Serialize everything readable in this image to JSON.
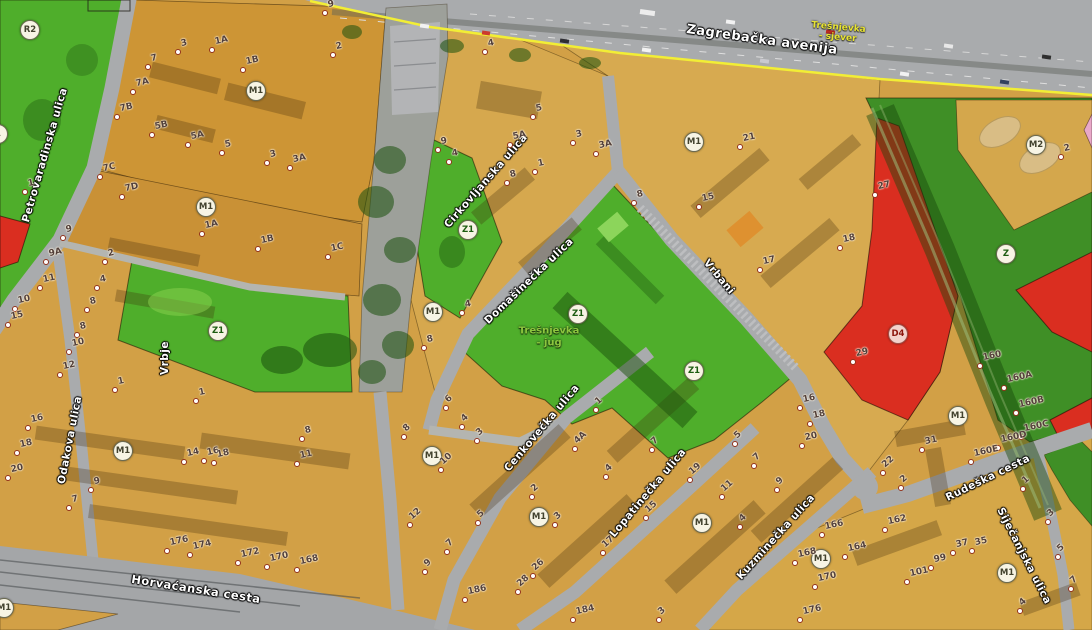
{
  "palette": {
    "zone-orange": "#d2a046",
    "zone-orange-dark": "#cd9535",
    "zone-orange-mid": "#c99136",
    "zone-orange-light": "#d7aa50",
    "zone-park": "#4fae2b",
    "zone-strip": "#3f8f26",
    "zone-red": "#da2e20",
    "zone-pink": "#e9a8c9",
    "road": "#a9abad",
    "road-light": "#b4b5b0",
    "corridor": "#9da09a",
    "boundary-yellow": "#f2ee35",
    "street-text": "#ffffff",
    "number-text": "#53403a",
    "area-sjever": "#e8e434",
    "area-jug": "#8cc63e",
    "circle-fill": "#f7f4e4",
    "circle-z": "#1c5c10",
    "circle-m": "#42422e",
    "circle-d": "#8c150c"
  },
  "map": {
    "streets": [
      {
        "name": "Petrovaradinska ulica",
        "x": 45,
        "y": 155,
        "rot": -74,
        "size": 10.5
      },
      {
        "name": "Odakova ulica",
        "x": 70,
        "y": 440,
        "rot": -79,
        "size": 10.5
      },
      {
        "name": "Cirkovljanska ulica",
        "x": 486,
        "y": 181,
        "rot": -49,
        "size": 10.5
      },
      {
        "name": "Domašinečka ulica",
        "x": 529,
        "y": 281,
        "rot": -44,
        "size": 10.5
      },
      {
        "name": "Vrbani",
        "x": 719,
        "y": 277,
        "rot": 50,
        "size": 10.5
      },
      {
        "name": "Vrbje",
        "x": 165,
        "y": 358,
        "rot": -90,
        "size": 10.5
      },
      {
        "name": "Zagrebačka avenija",
        "x": 762,
        "y": 40,
        "rot": 8,
        "size": 13
      },
      {
        "name": "Horvaćanska cesta",
        "x": 196,
        "y": 589,
        "rot": 9,
        "size": 11.5
      },
      {
        "name": "Cenkovečka ulica",
        "x": 542,
        "y": 428,
        "rot": -50,
        "size": 10.5
      },
      {
        "name": "Lopatinečka ulica",
        "x": 648,
        "y": 493,
        "rot": -50,
        "size": 10.5
      },
      {
        "name": "Kuzminečka ulica",
        "x": 776,
        "y": 537,
        "rot": -48,
        "size": 10.5
      },
      {
        "name": "Rudeška cesta",
        "x": 988,
        "y": 478,
        "rot": -26,
        "size": 10.5
      },
      {
        "name": "Siječanjska ulica",
        "x": 1024,
        "y": 556,
        "rot": 63,
        "size": 10.5
      }
    ],
    "area_labels": [
      {
        "line1": "Trešnjevka",
        "line2": "- sjever",
        "x": 838,
        "y": 33,
        "rot": 5,
        "size": 9,
        "color_key": "area-sjever"
      },
      {
        "line1": "Trešnjevka",
        "line2": "- jug",
        "x": 549,
        "y": 337,
        "rot": 0,
        "size": 10,
        "color_key": "area-jug"
      }
    ],
    "zone_labels": [
      {
        "code": "R2",
        "x": 29,
        "y": 29,
        "cls": "m"
      },
      {
        "code": "1",
        "x": -3,
        "y": 133,
        "cls": "m"
      },
      {
        "code": "M1",
        "x": 255,
        "y": 90,
        "cls": "m"
      },
      {
        "code": "M1",
        "x": 205,
        "y": 206,
        "cls": "m"
      },
      {
        "code": "Z1",
        "x": 217,
        "y": 330,
        "cls": "z"
      },
      {
        "code": "Z1",
        "x": 467,
        "y": 229,
        "cls": "z"
      },
      {
        "code": "M1",
        "x": 432,
        "y": 311,
        "cls": "m"
      },
      {
        "code": "Z1",
        "x": 577,
        "y": 313,
        "cls": "z"
      },
      {
        "code": "Z1",
        "x": 693,
        "y": 370,
        "cls": "z"
      },
      {
        "code": "M1",
        "x": 693,
        "y": 141,
        "cls": "m"
      },
      {
        "code": "M2",
        "x": 1035,
        "y": 144,
        "cls": "m"
      },
      {
        "code": "Z",
        "x": 1005,
        "y": 253,
        "cls": "z"
      },
      {
        "code": "D4",
        "x": 897,
        "y": 333,
        "cls": "d"
      },
      {
        "code": "M1",
        "x": 957,
        "y": 415,
        "cls": "m"
      },
      {
        "code": "M1",
        "x": 122,
        "y": 450,
        "cls": "m"
      },
      {
        "code": "M1",
        "x": 431,
        "y": 455,
        "cls": "m"
      },
      {
        "code": "M1",
        "x": 538,
        "y": 516,
        "cls": "m"
      },
      {
        "code": "M1",
        "x": 701,
        "y": 522,
        "cls": "m"
      },
      {
        "code": "M1",
        "x": 820,
        "y": 558,
        "cls": "m"
      },
      {
        "code": "M1",
        "x": 1006,
        "y": 572,
        "cls": "m"
      },
      {
        "code": "M1",
        "x": 3,
        "y": 607,
        "cls": "m"
      }
    ],
    "house_numbers": [
      [
        "7",
        148,
        67
      ],
      [
        "3",
        178,
        52
      ],
      [
        "1A",
        212,
        50
      ],
      [
        "1B",
        243,
        70
      ],
      [
        "7A",
        133,
        92
      ],
      [
        "7B",
        117,
        117
      ],
      [
        "5B",
        152,
        135
      ],
      [
        "5A",
        188,
        145
      ],
      [
        "5",
        222,
        153
      ],
      [
        "3",
        267,
        163
      ],
      [
        "3A",
        290,
        168
      ],
      [
        "2",
        333,
        55
      ],
      [
        "9",
        325,
        13
      ],
      [
        "7C",
        100,
        177
      ],
      [
        "7D",
        122,
        197
      ],
      [
        "1",
        25,
        192
      ],
      [
        "9",
        63,
        238
      ],
      [
        "9A",
        46,
        262
      ],
      [
        "11",
        40,
        288
      ],
      [
        "2",
        105,
        262
      ],
      [
        "4",
        97,
        288
      ],
      [
        "8",
        87,
        310
      ],
      [
        "10",
        15,
        309
      ],
      [
        "15",
        8,
        325
      ],
      [
        "8",
        77,
        335
      ],
      [
        "10",
        69,
        352
      ],
      [
        "12",
        60,
        375
      ],
      [
        "1",
        115,
        390
      ],
      [
        "1",
        196,
        401
      ],
      [
        "1A",
        202,
        234
      ],
      [
        "1B",
        258,
        249
      ],
      [
        "1C",
        328,
        257
      ],
      [
        "16",
        28,
        428
      ],
      [
        "18",
        17,
        453
      ],
      [
        "20",
        8,
        478
      ],
      [
        "9",
        91,
        490
      ],
      [
        "7",
        69,
        508
      ],
      [
        "14",
        184,
        462
      ],
      [
        "16",
        204,
        461
      ],
      [
        "18",
        214,
        463
      ],
      [
        "8",
        302,
        439
      ],
      [
        "11",
        297,
        464
      ],
      [
        "176",
        167,
        551
      ],
      [
        "174",
        190,
        555
      ],
      [
        "172",
        238,
        563
      ],
      [
        "170",
        267,
        567
      ],
      [
        "168",
        297,
        570
      ],
      [
        "4",
        485,
        52
      ],
      [
        "5",
        533,
        117
      ],
      [
        "5A",
        510,
        145
      ],
      [
        "3",
        573,
        143
      ],
      [
        "3A",
        596,
        154
      ],
      [
        "9",
        438,
        150
      ],
      [
        "4",
        449,
        162
      ],
      [
        "1",
        535,
        172
      ],
      [
        "8",
        507,
        183
      ],
      [
        "4",
        462,
        313
      ],
      [
        "8",
        424,
        348
      ],
      [
        "21",
        740,
        147
      ],
      [
        "27",
        875,
        195
      ],
      [
        "15",
        699,
        207
      ],
      [
        "18",
        840,
        248
      ],
      [
        "17",
        760,
        270
      ],
      [
        "8",
        634,
        203
      ],
      [
        "29",
        853,
        362
      ],
      [
        "160",
        980,
        366
      ],
      [
        "160A",
        1004,
        388
      ],
      [
        "160B",
        1016,
        413
      ],
      [
        "160C",
        1021,
        437
      ],
      [
        "160D",
        998,
        448
      ],
      [
        "160E",
        971,
        462
      ],
      [
        "31",
        922,
        450
      ],
      [
        "16",
        800,
        408
      ],
      [
        "18",
        810,
        424
      ],
      [
        "20",
        802,
        446
      ],
      [
        "6",
        446,
        408,
        -42
      ],
      [
        "4",
        462,
        427,
        -42
      ],
      [
        "3",
        477,
        441,
        -42
      ],
      [
        "8",
        404,
        437,
        -42
      ],
      [
        "10",
        441,
        470,
        -42
      ],
      [
        "12",
        410,
        525,
        -42
      ],
      [
        "5",
        478,
        523,
        -42
      ],
      [
        "7",
        447,
        552,
        -42
      ],
      [
        "9",
        425,
        572,
        -42
      ],
      [
        "186",
        465,
        600
      ],
      [
        "1",
        596,
        410,
        -42
      ],
      [
        "4A",
        575,
        449,
        -42
      ],
      [
        "4",
        606,
        477,
        -42
      ],
      [
        "2",
        532,
        497,
        -42
      ],
      [
        "3",
        555,
        525,
        -42
      ],
      [
        "26",
        533,
        576,
        -42
      ],
      [
        "28",
        518,
        592,
        -42
      ],
      [
        "184",
        573,
        620
      ],
      [
        "3",
        659,
        620,
        -42
      ],
      [
        "7",
        652,
        450,
        -42
      ],
      [
        "19",
        690,
        480,
        -42
      ],
      [
        "11",
        722,
        497,
        -42
      ],
      [
        "15",
        646,
        518,
        -42
      ],
      [
        "17",
        603,
        553,
        -42
      ],
      [
        "5",
        735,
        444,
        -42
      ],
      [
        "7",
        754,
        466,
        -42
      ],
      [
        "9",
        777,
        490,
        -42
      ],
      [
        "4",
        740,
        527,
        -42
      ],
      [
        "166",
        822,
        535
      ],
      [
        "162",
        885,
        530
      ],
      [
        "164",
        845,
        557
      ],
      [
        "168",
        795,
        563
      ],
      [
        "170",
        815,
        587
      ],
      [
        "176",
        800,
        620
      ],
      [
        "101",
        907,
        582
      ],
      [
        "99",
        931,
        568
      ],
      [
        "37",
        953,
        553
      ],
      [
        "35",
        972,
        551
      ],
      [
        "22",
        883,
        473,
        -42
      ],
      [
        "2",
        901,
        488,
        -42
      ],
      [
        "1",
        1023,
        489,
        -42
      ],
      [
        "3",
        1048,
        522,
        -42
      ],
      [
        "5",
        1058,
        557,
        -42
      ],
      [
        "7",
        1071,
        589,
        -42
      ],
      [
        "4",
        1020,
        611,
        -42
      ],
      [
        "2",
        1061,
        157
      ]
    ]
  }
}
